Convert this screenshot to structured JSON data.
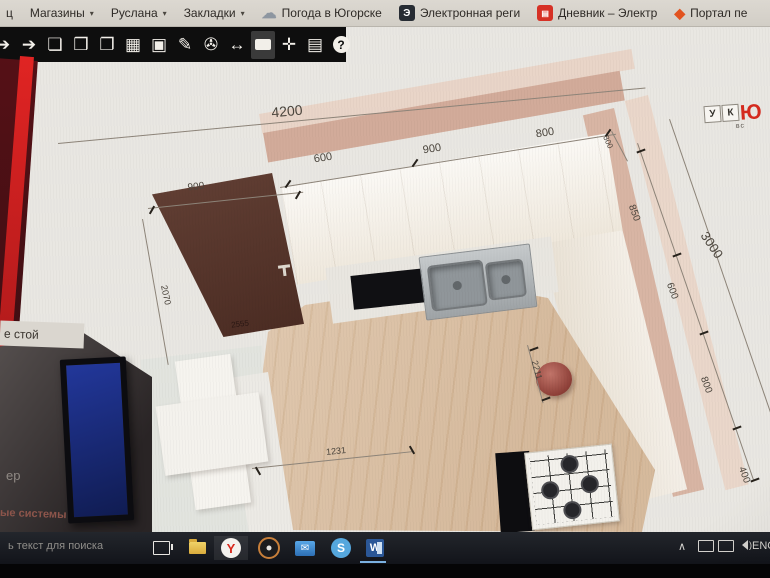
{
  "bookmarks_bar": {
    "edge_fragment": "ц",
    "items": [
      {
        "name": "bookmark-magaziny",
        "label": "Магазины",
        "arrow": "▾",
        "icon": ""
      },
      {
        "name": "bookmark-ruslana",
        "label": "Руслана",
        "arrow": "▾",
        "icon": ""
      },
      {
        "name": "bookmark-zakladki",
        "label": "Закладки",
        "arrow": "▾",
        "icon": ""
      },
      {
        "name": "bookmark-pogoda",
        "label": "Погода в Югорске",
        "arrow": "",
        "icon": "cloud",
        "glyph": "☁"
      },
      {
        "name": "bookmark-elektronnaya",
        "label": "Электронная реги",
        "arrow": "",
        "icon": "e",
        "glyph": "Э"
      },
      {
        "name": "bookmark-dnevnik",
        "label": "Дневник – Электр",
        "arrow": "",
        "icon": "reddoc",
        "glyph": "▤"
      },
      {
        "name": "bookmark-portal",
        "label": "Портал пе",
        "arrow": "",
        "icon": "diamond",
        "glyph": "◆"
      }
    ]
  },
  "toolbar": {
    "icons": [
      {
        "name": "arrow-left-partial-icon",
        "glyph": "➔",
        "type": "g",
        "first": true
      },
      {
        "name": "arrow-right-icon",
        "glyph": "➔",
        "type": "g"
      },
      {
        "name": "new-document-icon",
        "glyph": "❏",
        "type": "g"
      },
      {
        "name": "open-folder-icon",
        "glyph": "❒",
        "type": "g"
      },
      {
        "name": "save-icon",
        "glyph": "❐",
        "type": "g"
      },
      {
        "name": "print-icon",
        "glyph": "▦",
        "type": "g"
      },
      {
        "name": "image-icon",
        "glyph": "▣",
        "type": "g"
      },
      {
        "name": "pencil-icon",
        "glyph": "✎",
        "type": "g"
      },
      {
        "name": "camera-icon",
        "glyph": "✇",
        "type": "g"
      },
      {
        "name": "resize-horizontal-icon",
        "glyph": "↔",
        "type": "g"
      },
      {
        "name": "comment-icon",
        "glyph": "",
        "type": "bubble",
        "pressed": true
      },
      {
        "name": "expand-icon",
        "glyph": "✛",
        "type": "g"
      },
      {
        "name": "properties-icon",
        "glyph": "▤",
        "type": "g"
      },
      {
        "name": "help-icon",
        "glyph": "?",
        "type": "help"
      }
    ]
  },
  "logo": {
    "tile1": "У",
    "tile2": "К",
    "red": "Ю",
    "sub": "вс"
  },
  "kitchen": {
    "dimensions": [
      {
        "t": "4200",
        "x": 287,
        "y": 84,
        "r": -5,
        "fs": 14
      },
      {
        "t": "900",
        "x": 196,
        "y": 160,
        "r": -7,
        "fs": 10
      },
      {
        "t": "600",
        "x": 323,
        "y": 131,
        "r": -9,
        "fs": 11
      },
      {
        "t": "900",
        "x": 432,
        "y": 122,
        "r": -9,
        "fs": 11
      },
      {
        "t": "800",
        "x": 545,
        "y": 106,
        "r": -9,
        "fs": 11
      },
      {
        "t": "300",
        "x": 608,
        "y": 115,
        "r": 66,
        "fs": 8
      },
      {
        "t": "850",
        "x": 634,
        "y": 186,
        "r": 70,
        "fs": 10
      },
      {
        "t": "600",
        "x": 672,
        "y": 264,
        "r": 70,
        "fs": 10
      },
      {
        "t": "3000",
        "x": 712,
        "y": 218,
        "r": 56,
        "fs": 13
      },
      {
        "t": "800",
        "x": 706,
        "y": 358,
        "r": 70,
        "fs": 10
      },
      {
        "t": "400",
        "x": 744,
        "y": 448,
        "r": 70,
        "fs": 10
      },
      {
        "t": "2070",
        "x": 166,
        "y": 268,
        "r": 78,
        "fs": 9
      },
      {
        "t": "2555",
        "x": 240,
        "y": 297,
        "r": -7,
        "fs": 8,
        "c": "#2a1713"
      },
      {
        "t": "1231",
        "x": 336,
        "y": 424,
        "r": -6,
        "fs": 9
      },
      {
        "t": "2211",
        "x": 537,
        "y": 343,
        "r": 75,
        "fs": 9
      },
      {
        "t": "3364",
        "x": 398,
        "y": 511,
        "r": 187,
        "fs": 9
      }
    ],
    "lines": [
      {
        "x": 58,
        "y": 116,
        "len": 590,
        "r": -5.4
      },
      {
        "x": 280,
        "y": 160,
        "len": 340,
        "r": -9
      },
      {
        "x": 612,
        "y": 104,
        "len": 34,
        "r": 62
      },
      {
        "x": 638,
        "y": 116,
        "len": 356,
        "r": 71
      },
      {
        "x": 670,
        "y": 92,
        "len": 330,
        "r": 71
      },
      {
        "x": 148,
        "y": 181,
        "len": 156,
        "r": -6
      },
      {
        "x": 143,
        "y": 192,
        "len": 148,
        "r": 80
      },
      {
        "x": 252,
        "y": 441,
        "len": 162,
        "r": -6
      },
      {
        "x": 528,
        "y": 318,
        "len": 60,
        "r": 75
      }
    ],
    "ticks": [
      {
        "x": 288,
        "y": 157,
        "r": -55
      },
      {
        "x": 415,
        "y": 136,
        "r": -55
      },
      {
        "x": 608,
        "y": 106,
        "r": -55
      },
      {
        "x": 641,
        "y": 124,
        "r": -20
      },
      {
        "x": 677,
        "y": 228,
        "r": -20
      },
      {
        "x": 704,
        "y": 306,
        "r": -20
      },
      {
        "x": 737,
        "y": 401,
        "r": -20
      },
      {
        "x": 755,
        "y": 453,
        "r": -20
      },
      {
        "x": 152,
        "y": 183,
        "r": -60
      },
      {
        "x": 298,
        "y": 168,
        "r": -60
      },
      {
        "x": 258,
        "y": 444,
        "r": 60
      },
      {
        "x": 412,
        "y": 423,
        "r": 60
      },
      {
        "x": 534,
        "y": 322,
        "r": -20
      },
      {
        "x": 546,
        "y": 372,
        "r": -20
      }
    ]
  },
  "left_screen": {
    "box_text": "е стой",
    "frag1": "ер",
    "frag2": "ые системы"
  },
  "taskbar": {
    "search_fragment": "ь текст для поиска",
    "yandex_letter": "Y",
    "skype_letter": "S",
    "word_letter": "W",
    "mail_glyph": "✉",
    "tray": {
      "chevron": "∧",
      "lang": "ENG"
    }
  }
}
